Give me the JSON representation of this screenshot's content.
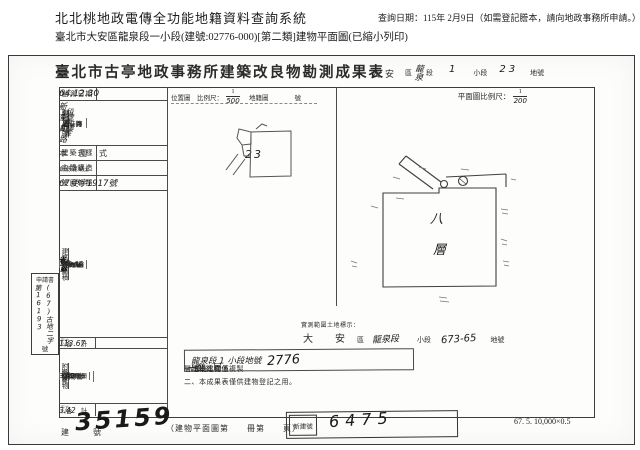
{
  "page_header": {
    "system_title": "北北桃地政電傳全功能地籍資料查詢系統",
    "query_date_note": "查詢日期：115年 2月9日（如需登記謄本，請向地政事務所申請。）",
    "subtitle": "臺北市大安區龍泉段一小段(建號:02776-000)[第二類]建物平面圖(已縮小列印)"
  },
  "document": {
    "title": "臺北市古亭地政事務所建築改良物勘測成果表",
    "land_ref": {
      "district": "大安",
      "district_label": "區",
      "section": "龍泉",
      "section_label": "段",
      "subsection": "1",
      "subsection_label": "小段",
      "lot": "23",
      "lot_label": "地號"
    },
    "survey": {
      "label": "勘測日期",
      "value": "64.12.30"
    },
    "door_plate": {
      "group_label": "建物門牌",
      "rows": [
        {
          "label": "街　路",
          "value": "新生南路"
        },
        {
          "label": "段巷弄",
          "value": "3段　巷　弄"
        },
        {
          "label": "門　牌",
          "value": "4號　8樓"
        }
      ]
    },
    "style": {
      "label": "建築式樣",
      "value": "本　國　式"
    },
    "structure": {
      "label": "主體構造",
      "value": "鋼筋混凝土"
    },
    "license": {
      "label": "使用執照",
      "value": "67使字1917號"
    },
    "floors": {
      "section_label": "建築物面積",
      "unit": "平方公尺",
      "rows": [
        {
          "label": "第一層",
          "value": "省. 略"
        },
        {
          "label": "第二層",
          "value": "省. 略"
        },
        {
          "label": "第三層",
          "value": "省. 略"
        },
        {
          "label": "第四層",
          "value": "省. 略"
        },
        {
          "label": "第五層",
          "value": "省. 略"
        },
        {
          "label": "第六層",
          "value": "省. 略"
        },
        {
          "label": "第七層",
          "value": "省. 略"
        },
        {
          "label": "第八層",
          "value": "113.67"
        },
        {
          "label": "第九層",
          "value": "省. 略"
        },
        {
          "label": "第十層",
          "value": "省. 略"
        },
        {
          "label": "第十一層",
          "value": "省. 略"
        },
        {
          "label": "第十二層",
          "value": "省. 略"
        },
        {
          "label": "第十三層",
          "value": "省. 略"
        },
        {
          "label": "第十四層",
          "value": "省. 略"
        },
        {
          "label": "",
          "value": "・"
        },
        {
          "label": "",
          "value": "・"
        },
        {
          "label": "",
          "value": "・"
        },
        {
          "label": "",
          "value": "・"
        }
      ],
      "total_label": "合　計",
      "total_value": "113.67"
    },
    "annex": {
      "section_label": "附屬建物",
      "headers": {
        "use": "使用種類",
        "structure": "主體構造",
        "area": "面　積"
      },
      "rows": [
        {
          "use": "陽台",
          "structure": "鋼筋混凝土",
          "area": "3.42"
        },
        {
          "use": "",
          "structure": "",
          "area": "・"
        },
        {
          "use": "",
          "structure": "",
          "area": "・"
        },
        {
          "use": "",
          "structure": "",
          "area": "・"
        },
        {
          "use": "",
          "structure": "",
          "area": "・"
        }
      ],
      "total_label": "合　計",
      "total_value": "3.42",
      "unit": "平方公尺"
    },
    "application": {
      "label": "申請書",
      "number": "(67)古地二字第16193",
      "suffix": "號"
    },
    "location_map": {
      "header": "位置圖　比例尺：",
      "scale_num": "1",
      "scale_den": "500",
      "ref_label": "地籍圖",
      "ref_suffix": "號",
      "lot_hand": "23"
    },
    "floor_plan": {
      "header": "平面圖比例尺：",
      "scale_num": "1",
      "scale_den": "200",
      "room_char_1": "八",
      "room_char_2": "層"
    },
    "land_note": {
      "heading": "實測範圍土地標示：",
      "district": "大　安",
      "district_label": "區",
      "section_hand": "龍泉段",
      "subsection_label": "小段",
      "lot_hand": "673-65",
      "lot_label": "地號"
    },
    "boxed_note": {
      "hand_text": "龍泉段 1 小段地號",
      "hand_number": "2776"
    },
    "notes": {
      "n1_prefix": "一、本建物係",
      "n1_hand": "十四",
      "n1_mid": "層建物本件僅複製",
      "n1_floor": "八　層",
      "n1_suffix": "部分。",
      "n2_text": "二、本成果表僅供建物登記之用。"
    },
    "footer": {
      "reg_label": "建　號",
      "reg_number": "35159",
      "plan_book": "（建物平面圖第　　冊第　　頁）",
      "new_label": "新建號",
      "new_number": "6475",
      "print_code": "67. 5. 10,000×0.5"
    }
  }
}
